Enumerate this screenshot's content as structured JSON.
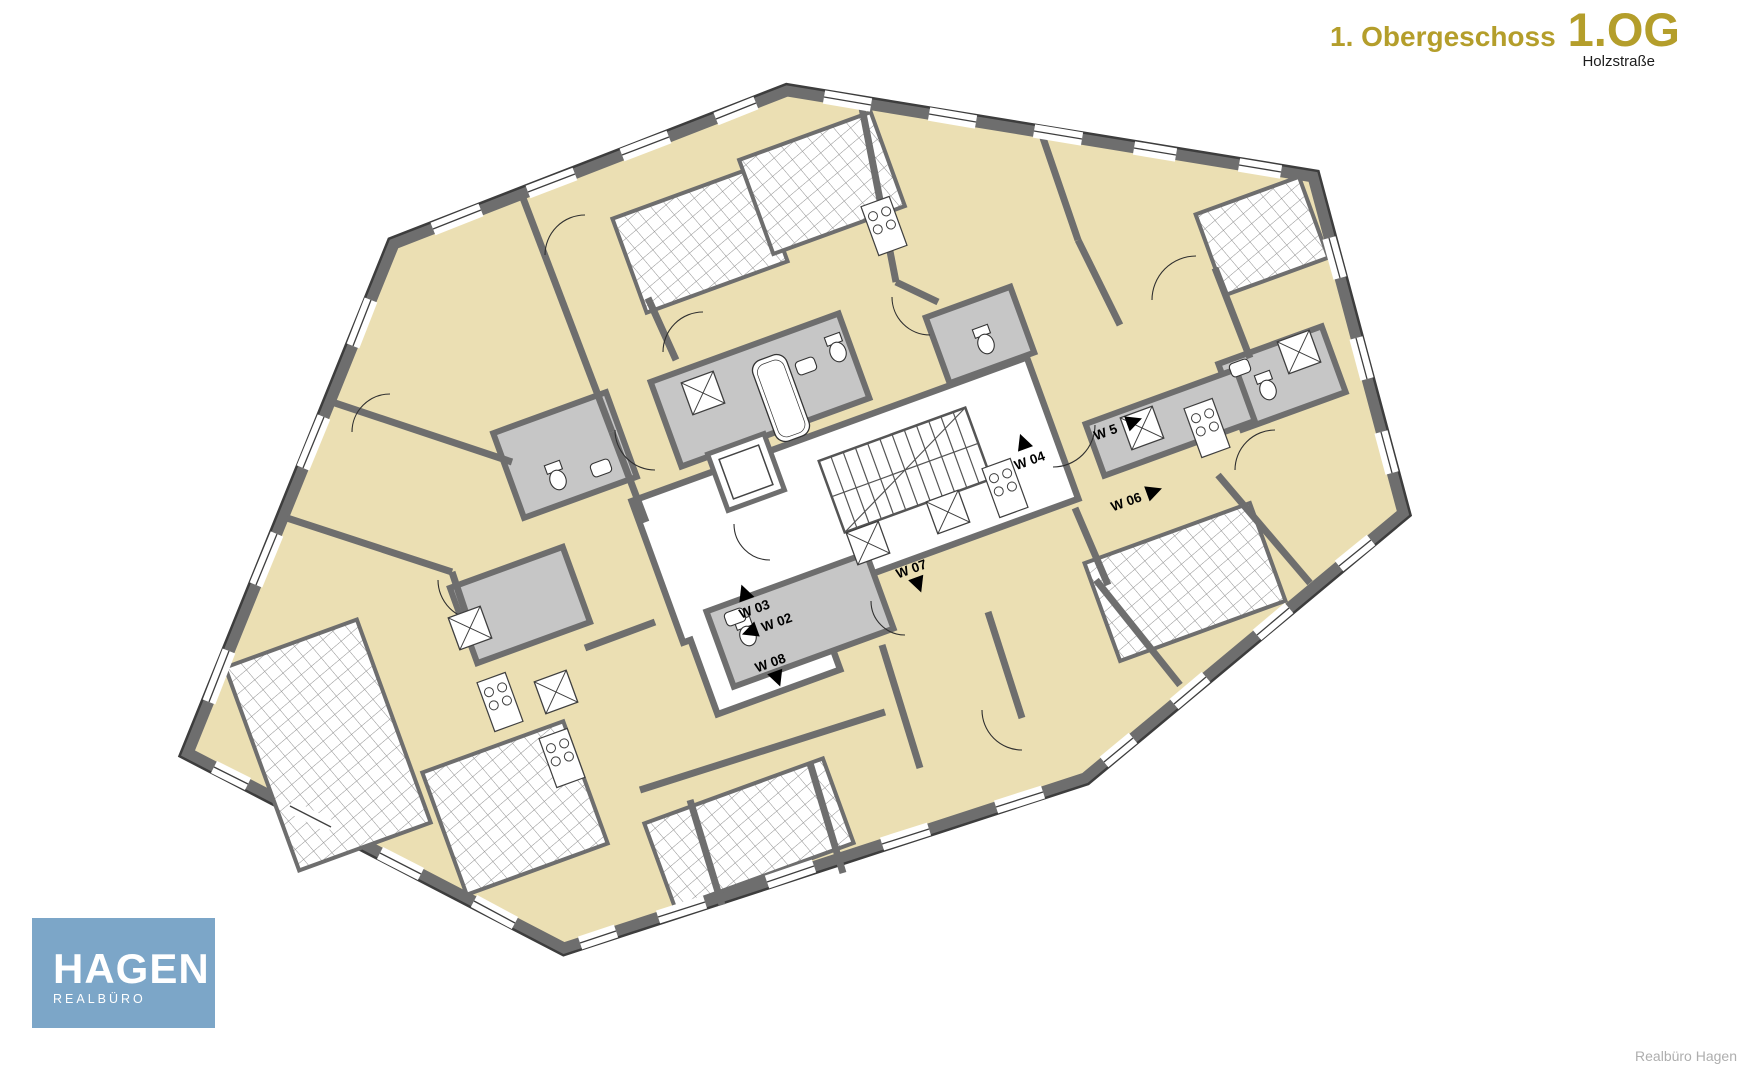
{
  "header": {
    "floor_name": "1. Obergeschoss",
    "floor_code": "1.OG",
    "street": "Holzstraße"
  },
  "plan": {
    "type": "apartment-floor-plan",
    "units": [
      {
        "id": "W02",
        "label": "W 02",
        "arrow": "left"
      },
      {
        "id": "W03",
        "label": "W 03",
        "arrow": "up"
      },
      {
        "id": "W04",
        "label": "W 04",
        "arrow": "up"
      },
      {
        "id": "W5",
        "label": "W 5",
        "arrow": "right"
      },
      {
        "id": "W06",
        "label": "W 06",
        "arrow": "right"
      },
      {
        "id": "W07",
        "label": "W 07",
        "arrow": "down"
      },
      {
        "id": "W08",
        "label": "W 08",
        "arrow": "down"
      }
    ]
  },
  "logo": {
    "name": "HAGEN",
    "subtitle": "REALBÜRO"
  },
  "footer": {
    "credit": "Realbüro Hagen"
  },
  "colors": {
    "accent_gold": "#b49e2b",
    "logo_blue": "#7ca6c8",
    "room_beige": "#ebdfb3",
    "wall_gray": "#6e6e6e",
    "wet_room_gray": "#c6c6c6",
    "credit_gray": "#aeaeae"
  }
}
